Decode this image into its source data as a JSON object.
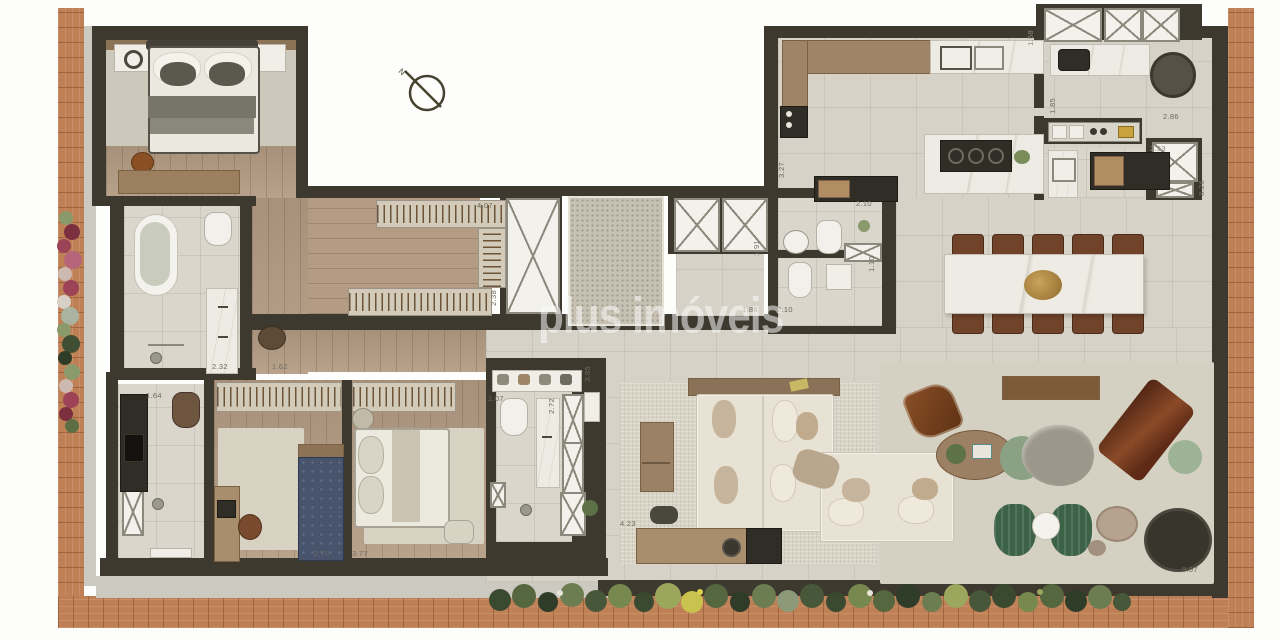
{
  "watermark": "plus imóveis",
  "compass": {
    "label": "N"
  },
  "dims": {
    "closet_w": "4.07",
    "closet_d": "2.38",
    "mbath_a": "2.32",
    "mbath_b": "1.62",
    "bath3_w": "1.64",
    "bed3_w": "2.70",
    "bed4_w": "3.77",
    "bath4_a": "1.07",
    "bath4_b": "2.72",
    "bath4_c": "3.85",
    "living_a": "4.23",
    "hall_a": "1.88",
    "hall_b": "2.10",
    "hall_c": "1.91",
    "powder_a": "2.10",
    "powder_b": "1.10",
    "kitchen_a": "3.27",
    "service_a": "1.58",
    "service_b": "1.85",
    "service_c": "2.86",
    "service_d": "2.53",
    "right_v": "8.26",
    "living_w": "9.07"
  },
  "colors": {
    "wall": "#3d392e",
    "deck_wood": "#c08055",
    "tile_floor": "#d6d2c7",
    "plank_floor": "#b29a82",
    "accent_green": "#3c6247",
    "accent_leather": "#7a4a2e"
  }
}
